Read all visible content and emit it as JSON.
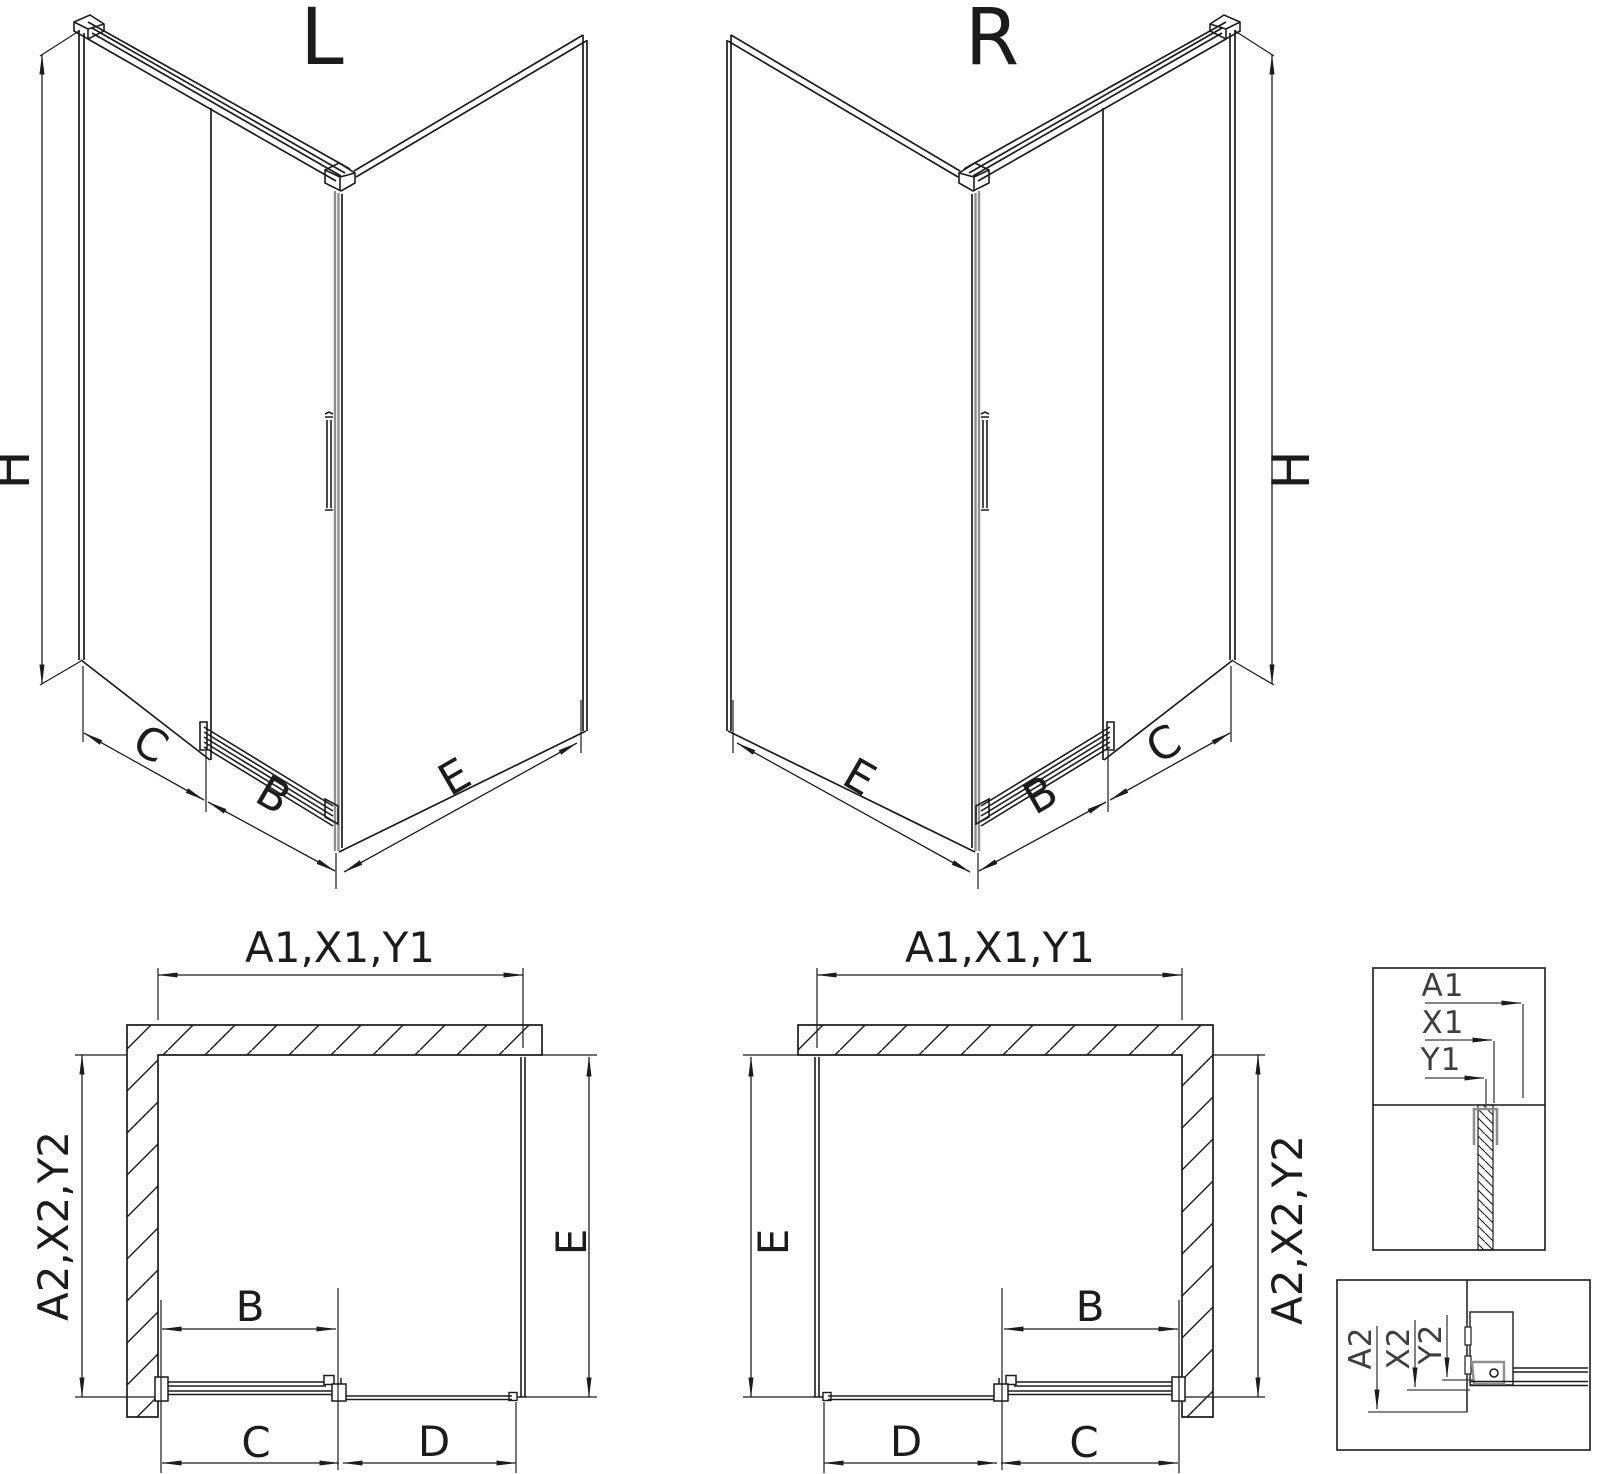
{
  "drawing": {
    "iso_left": {
      "title": "L",
      "dim_height": "H",
      "dim_side": "C",
      "dim_door": "B",
      "dim_return": "E"
    },
    "iso_right": {
      "title": "R",
      "dim_height": "H",
      "dim_side": "C",
      "dim_door": "B",
      "dim_return": "E"
    },
    "plan_left": {
      "dim_width": "A1,X1,Y1",
      "dim_depth_left": "A2,X2,Y2",
      "dim_depth_right": "E",
      "dim_door": "B",
      "dim_bottom_left": "C",
      "dim_bottom_right": "D"
    },
    "plan_right": {
      "dim_width": "A1,X1,Y1",
      "dim_depth_right": "A2,X2,Y2",
      "dim_depth_left": "E",
      "dim_door": "B",
      "dim_bottom_left": "D",
      "dim_bottom_right": "C"
    },
    "detail_top_profile": {
      "dim_a": "A1",
      "dim_x": "X1",
      "dim_y": "Y1"
    },
    "detail_bottom_profile": {
      "dim_a": "A2",
      "dim_x": "X2",
      "dim_y": "Y2"
    }
  },
  "colors": {
    "line": "#1c1c1c",
    "gray": "#8e8e8e",
    "detail_text": "#3e3e3e",
    "background": "#ffffff"
  }
}
